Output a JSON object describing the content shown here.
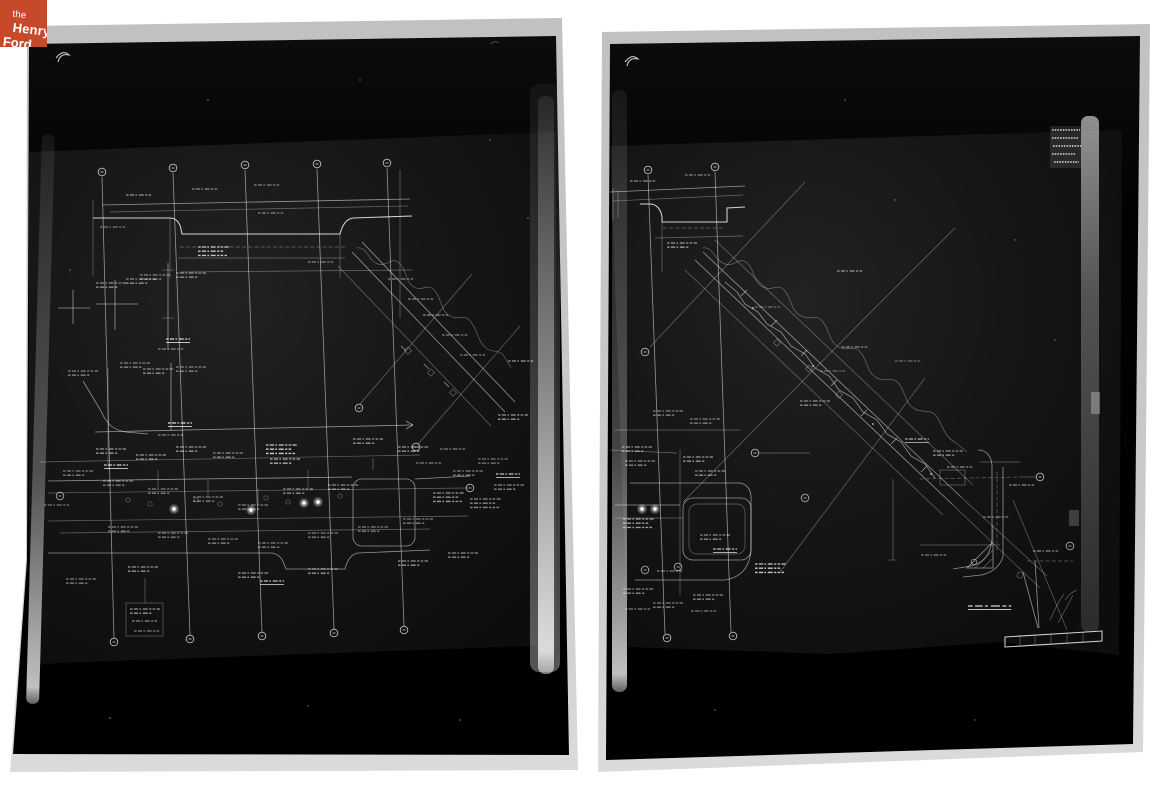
{
  "page": {
    "background_color": "#ffffff",
    "content": "Two black-and-white photographs of film negatives of engineering construction drawings, side by side on a white background"
  },
  "logo": {
    "word_the": "the",
    "word_henry": "Henry",
    "word_ford": "Ford",
    "bg_color": "#c7492c",
    "text_color": "#ffffff"
  },
  "photos": {
    "left": {
      "name": "drawing-negative-left",
      "description": "Film negative: road plan and profile drawing with five station grid lines, underpass profile at top, diagonal channel at right, dense annotated roadway plan across lower half",
      "film_color": "#050505",
      "frame_color": "#c9c9c9",
      "line_color": "#eaeaea"
    },
    "right": {
      "name": "drawing-negative-right",
      "description": "Film negative: road plan drawing dominated by a diagonal channel corridor from upper left to lower right, interchange detail at lower left, ramp detail at right, small stamp patch at upper right",
      "film_color": "#050505",
      "frame_color": "#c9c9c9",
      "line_color": "#eaeaea"
    }
  }
}
